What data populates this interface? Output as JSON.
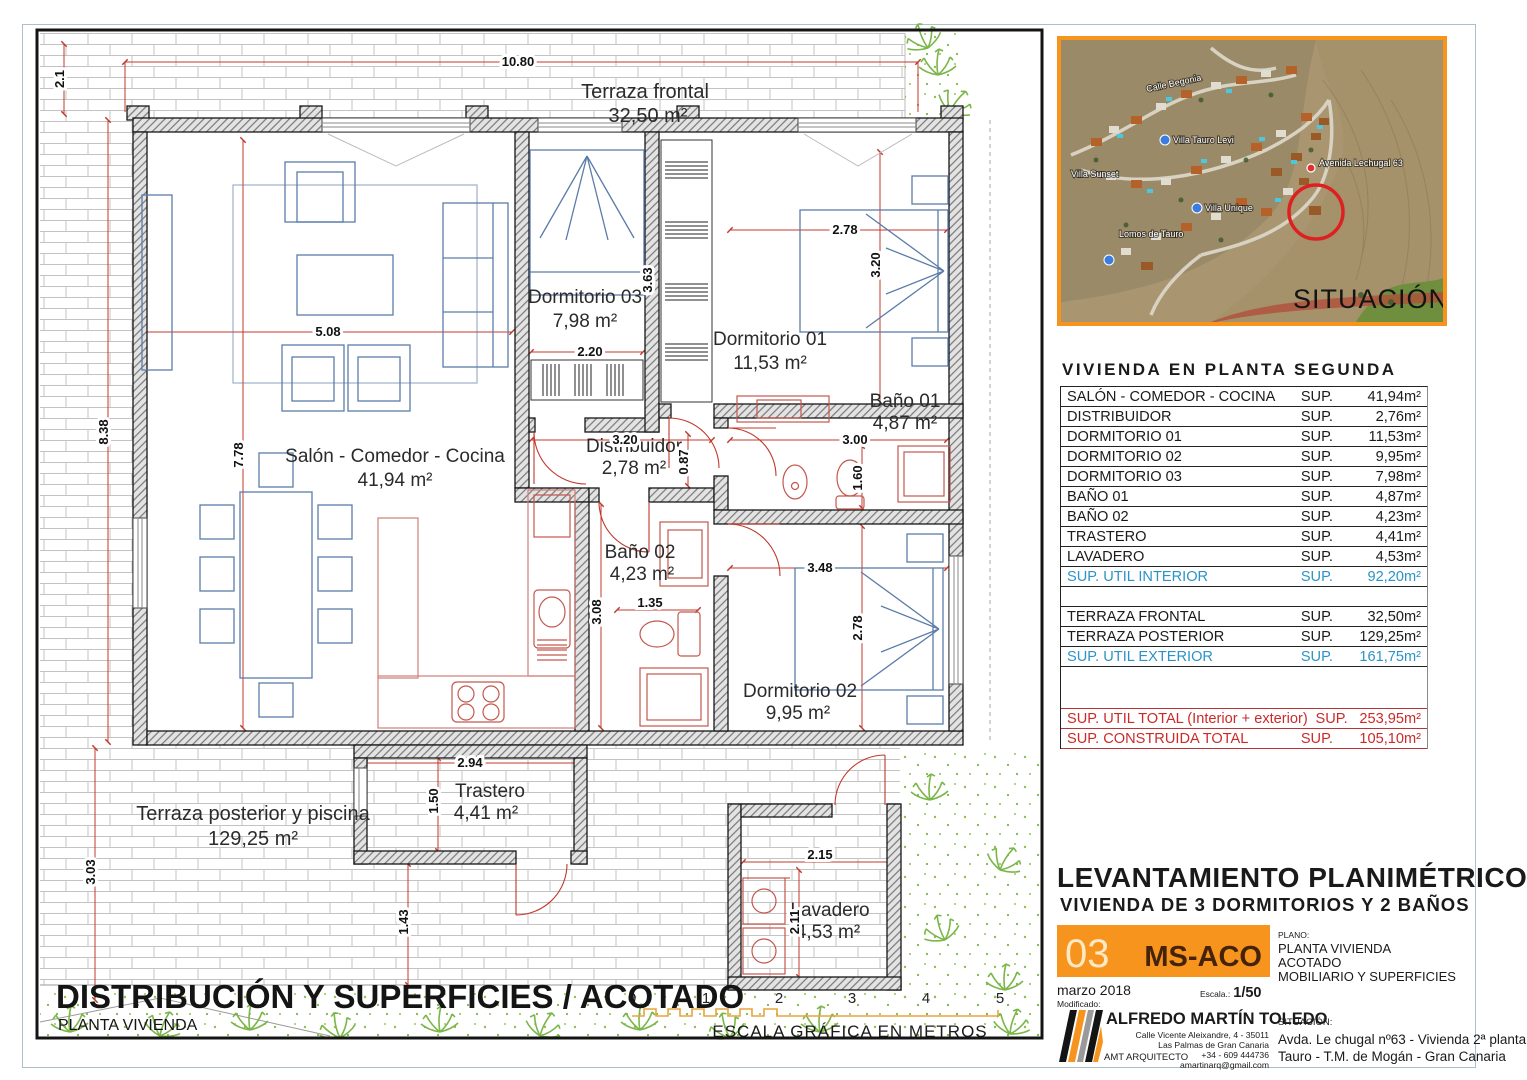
{
  "colors": {
    "accent_orange": "#f7941d",
    "dim_red": "#c0392b",
    "furniture_blue": "#5a7ca8",
    "table_blue": "#2b93c7",
    "table_red": "#cc2a2a",
    "green": "#7ab648"
  },
  "plan": {
    "rooms": {
      "salon": {
        "name": "Salón - Comedor - Cocina",
        "area": "41,94 m²"
      },
      "distribuidor": {
        "name": "Distribuidor",
        "area": "2,78 m²"
      },
      "dorm01": {
        "name": "Dormitorio 01",
        "area": "11,53 m²"
      },
      "dorm02": {
        "name": "Dormitorio 02",
        "area": "9,95 m²"
      },
      "dorm03": {
        "name": "Dormitorio 03",
        "area": "7,98 m²"
      },
      "bano01": {
        "name": "Baño 01",
        "area": "4,87 m²"
      },
      "bano02": {
        "name": "Baño 02",
        "area": "4,23 m²"
      },
      "trastero": {
        "name": "Trastero",
        "area": "4,41 m²"
      },
      "lavadero": {
        "name": "Lavadero",
        "area": "4,53 m²"
      },
      "terraza_frontal": {
        "name": "Terraza frontal",
        "area": "32,50 m²"
      },
      "terraza_posterior": {
        "name": "Terraza posterior y piscina",
        "area": "129,25 m²"
      }
    },
    "dims": {
      "terraza_offset": "2.1",
      "top": "10.80",
      "left": "8.38",
      "left_bottom": "3.03",
      "salon_v": "7.78",
      "salon_h": "5.08",
      "dorm03_v": "3.63",
      "dorm03_h": "2.20",
      "dorm01_v": "3.20",
      "dorm01_h": "2.78",
      "distrib_h": "3.20",
      "distrib_v": "0.87",
      "bano01_h": "3.00",
      "bano01_v": "1.60",
      "dorm02_h": "3.48",
      "dorm02_v": "2.78",
      "bano02_v": "3.08",
      "bano02_h": "1.35",
      "trastero_h": "2.94",
      "trastero_v": "1.50",
      "trastero_gap": "1.43",
      "lavadero_h": "2.15",
      "lavadero_v": "2.11"
    },
    "footer": {
      "title": "DISTRIBUCIÓN Y SUPERFICIES / ACOTADO",
      "subtitle": "PLANTA VIVIENDA"
    },
    "scalebar": {
      "ticks": [
        "0",
        "1",
        "2",
        "3",
        "4",
        "5"
      ],
      "caption": "ESCALA GRÁFICA EN METROS"
    }
  },
  "map": {
    "labels": [
      "Villa Tauro Levi",
      "Villa Unique",
      "Avenida Lechugal 63",
      "Villa Sunset",
      "Lomos de Tauro",
      "Calle Begonia"
    ],
    "caption": "SITUACIÓN"
  },
  "panel": {
    "table": {
      "title": "VIVIENDA EN PLANTA SEGUNDA",
      "rows": [
        {
          "label": "SALÓN - COMEDOR - COCINA",
          "sup": "SUP.",
          "value": "41,94m²"
        },
        {
          "label": "DISTRIBUIDOR",
          "sup": "SUP.",
          "value": "2,76m²"
        },
        {
          "label": "DORMITORIO 01",
          "sup": "SUP.",
          "value": "11,53m²"
        },
        {
          "label": "DORMITORIO 02",
          "sup": "SUP.",
          "value": "9,95m²"
        },
        {
          "label": "DORMITORIO 03",
          "sup": "SUP.",
          "value": "7,98m²"
        },
        {
          "label": "BAÑO 01",
          "sup": "SUP.",
          "value": "4,87m²"
        },
        {
          "label": "BAÑO 02",
          "sup": "SUP.",
          "value": "4,23m²"
        },
        {
          "label": "TRASTERO",
          "sup": "SUP.",
          "value": "4,41m²"
        },
        {
          "label": "LAVADERO",
          "sup": "SUP.",
          "value": "4,53m²"
        },
        {
          "label": "SUP. UTIL INTERIOR",
          "sup": "SUP.",
          "value": "92,20m²"
        },
        {
          "label": "TERRAZA FRONTAL",
          "sup": "SUP.",
          "value": "32,50m²"
        },
        {
          "label": "TERRAZA POSTERIOR",
          "sup": "SUP.",
          "value": "129,25m²"
        },
        {
          "label": "SUP. UTIL EXTERIOR",
          "sup": "SUP.",
          "value": "161,75m²"
        },
        {
          "label": "SUP. UTIL  TOTAL (Interior + exterior)",
          "sup": "SUP.",
          "value": "253,95m²"
        },
        {
          "label": "SUP. CONSTRUIDA TOTAL",
          "sup": "SUP.",
          "value": "105,10m²"
        }
      ]
    },
    "header": {
      "title": "LEVANTAMIENTO PLANIMÉTRICO",
      "subtitle": "VIVIENDA DE 3 DORMITORIOS Y 2 BAÑOS"
    },
    "block": {
      "number": "03",
      "code": "MS-ACO",
      "date": "marzo 2018",
      "modified_label": "Modificado:",
      "escala_label": "Escala.:",
      "escala_value": "1/50",
      "plano_label": "PLANO:",
      "plano_lines": [
        "PLANTA VIVIENDA",
        "ACOTADO",
        "MOBILIARIO Y SUPERFICIES"
      ]
    },
    "architect": {
      "name": "ALFREDO MARTÍN TOLEDO",
      "address": [
        "Calle Vicente Aleixandre, 4 - 35011",
        "Las Palmas de Gran Canaria",
        "+34 - 609 444736",
        "amartinarq@gmail.com"
      ],
      "role": "AMT ARQUITECTO",
      "situacion_label": "SITUACIÓN:",
      "situacion1": "Avda. Le chugal nº63 - Vivienda 2ª planta",
      "situacion2": "Tauro - T.M. de Mogán - Gran Canaria"
    }
  }
}
